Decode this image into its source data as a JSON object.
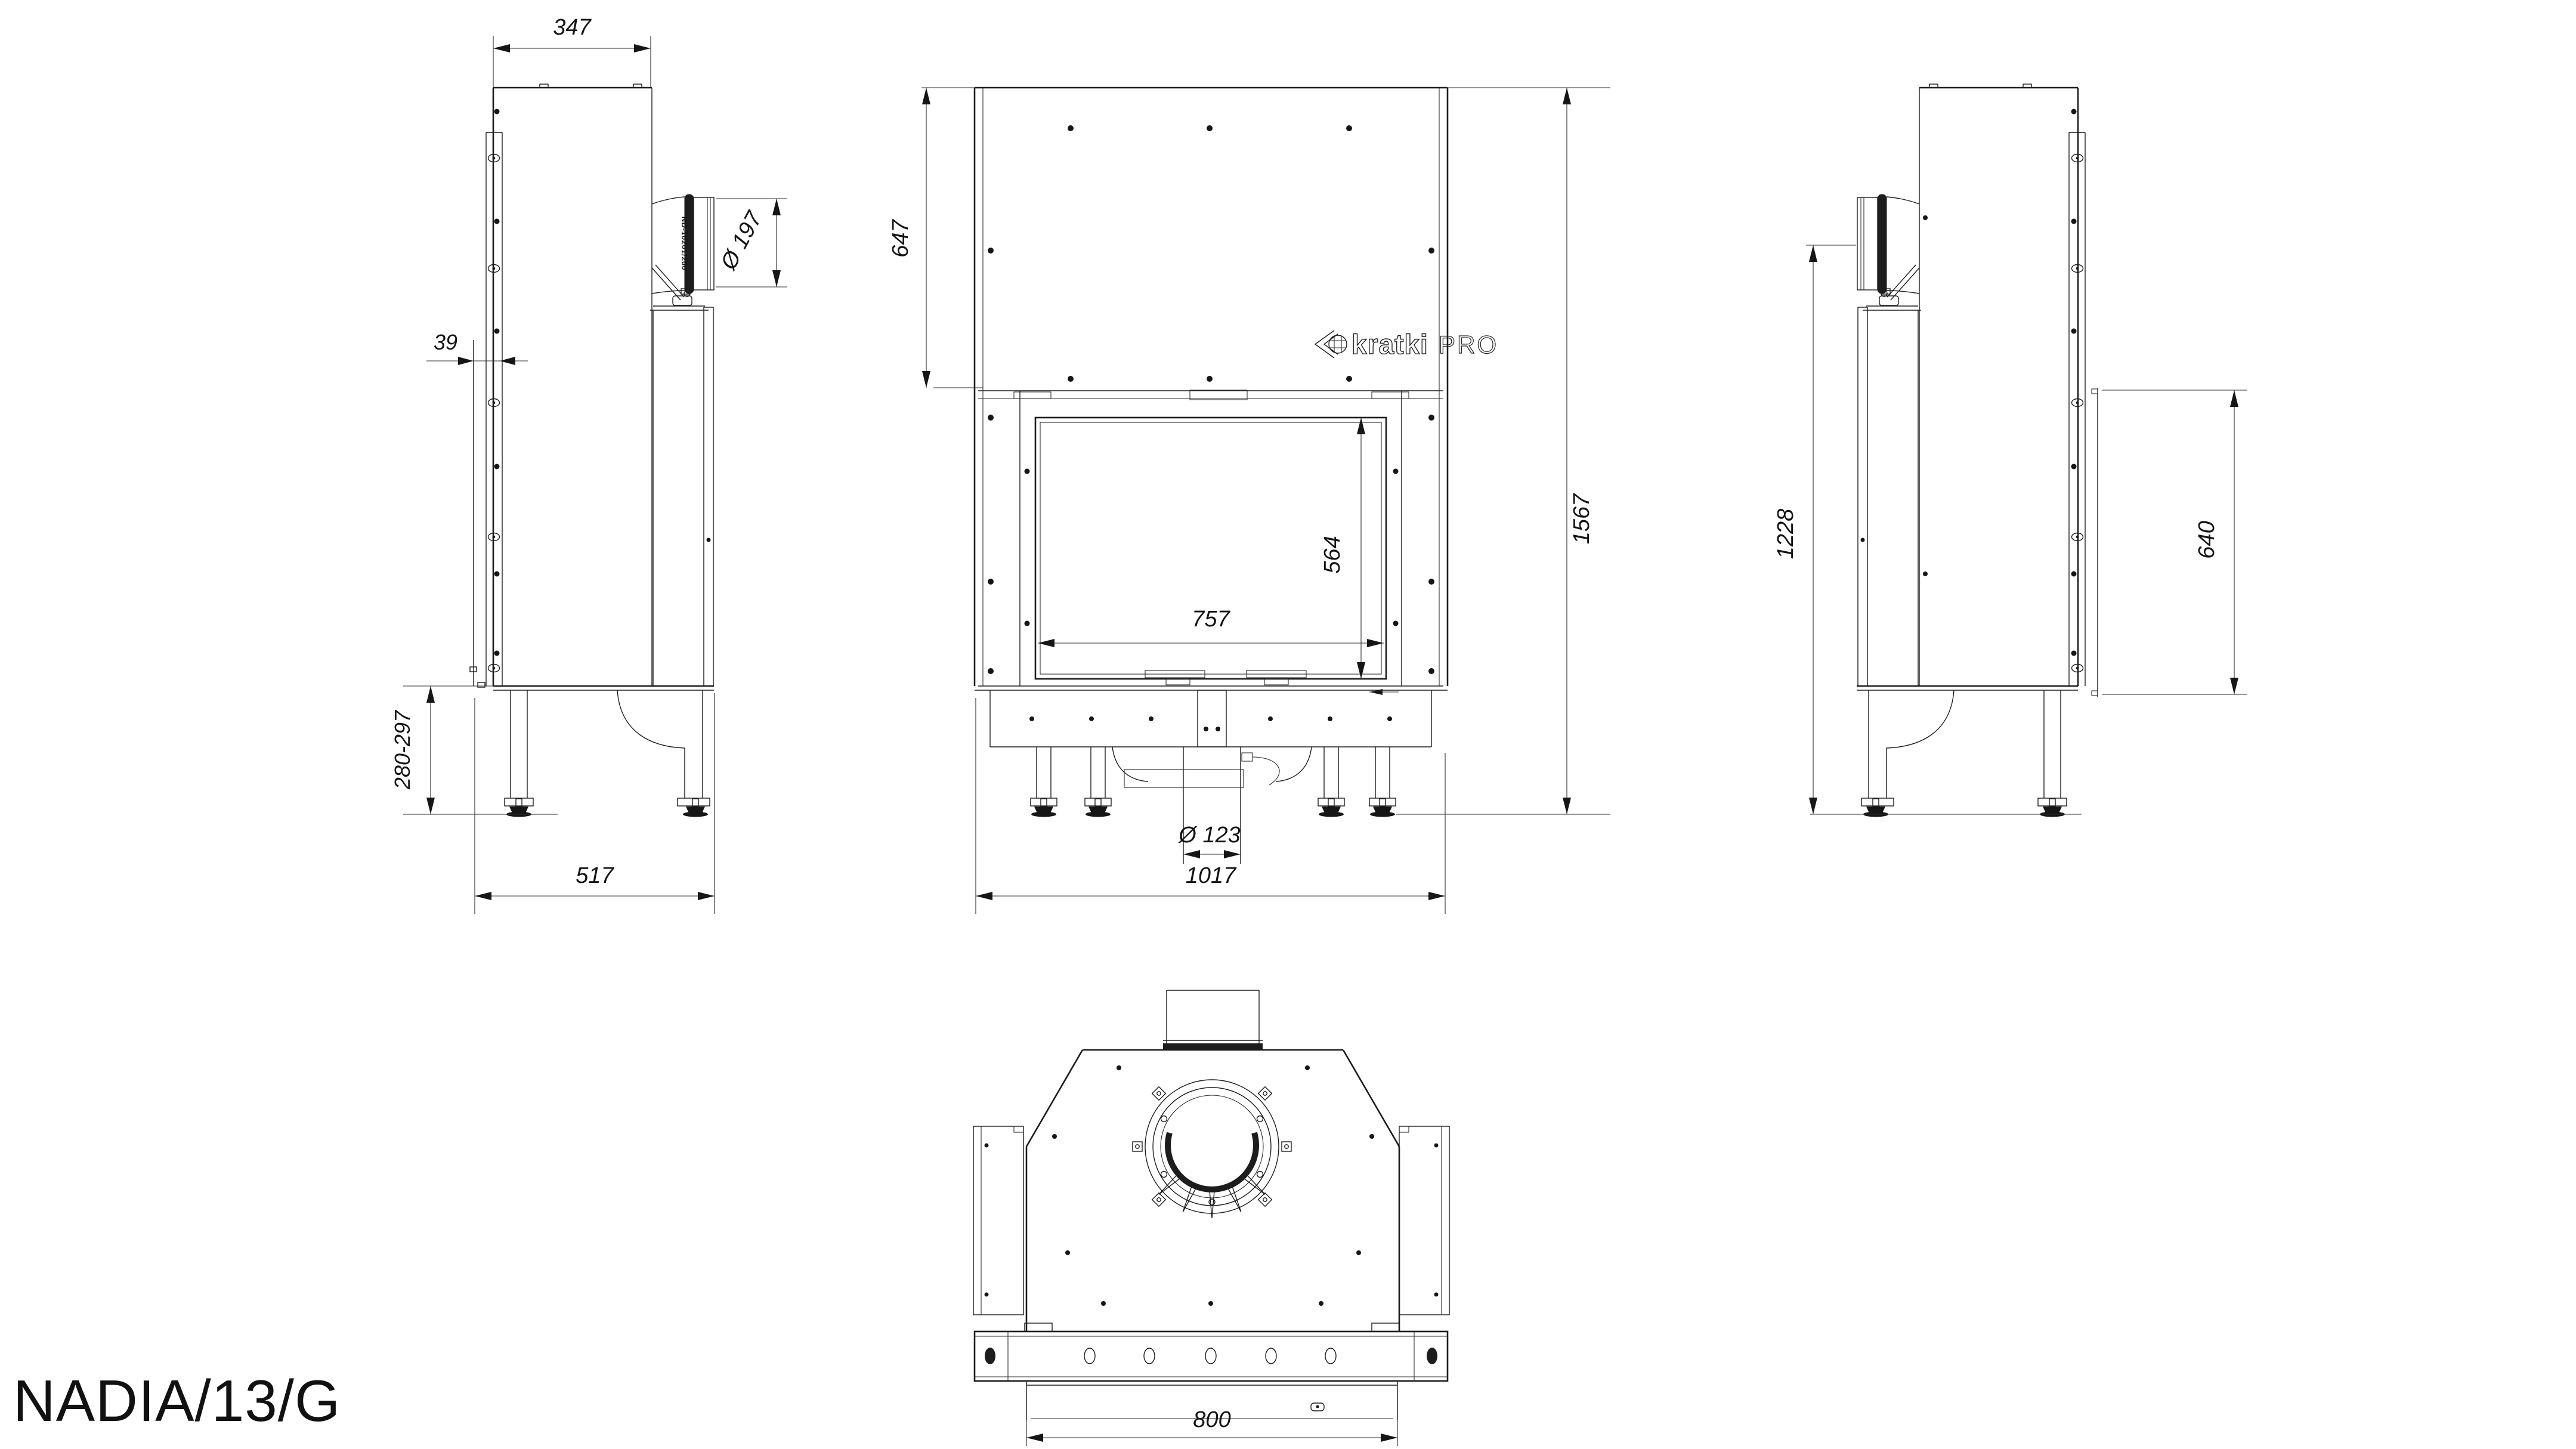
{
  "page": {
    "model": "NADIA/13/G"
  },
  "brand": {
    "name": "kratki",
    "suffix": "PRO"
  },
  "left_view": {
    "label": "left-side-view",
    "dims": {
      "top_depth": "347",
      "flue_diameter": "Ø 197",
      "front_offset": "39",
      "leg_height_range": "280-297",
      "overall_depth": "517"
    },
    "damper_code": "ND-10201/200"
  },
  "front_view": {
    "label": "front-view",
    "dims": {
      "top_section_height": "647",
      "glass_height": "564",
      "glass_width": "757",
      "overall_height": "1567",
      "air_inlet_diameter": "Ø 123",
      "overall_width": "1017"
    }
  },
  "right_view": {
    "label": "right-side-view",
    "dims": {
      "flue_axis_height": "1228",
      "front_panel_height": "640"
    }
  },
  "top_view": {
    "label": "top-view",
    "dims": {
      "front_glass_width": "800"
    }
  }
}
